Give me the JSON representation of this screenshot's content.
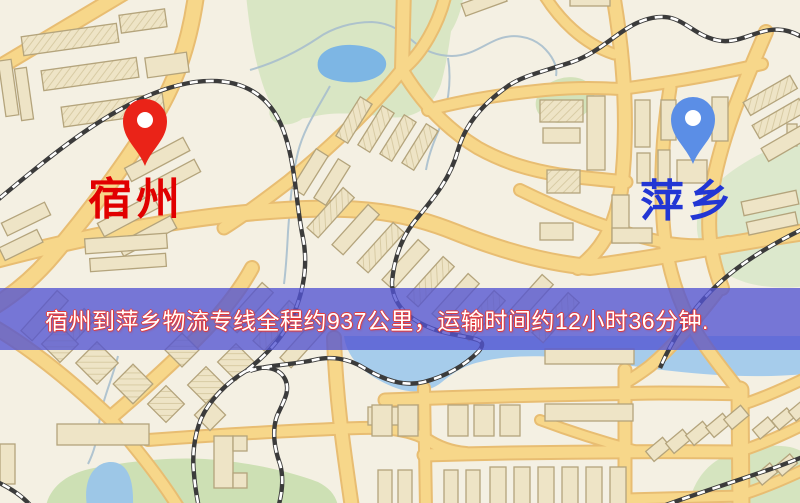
{
  "banner": {
    "text": "宿州到萍乡物流专线全程约937公里，运输时间约12小时36分钟.",
    "background_color": "#5253d2",
    "background_opacity": "0.78",
    "text_color": "#ffffff",
    "outline_color": "#e23b3b"
  },
  "markers": {
    "origin": {
      "label": "宿州",
      "label_color": "#e10000",
      "pin_color": "#ea2318"
    },
    "destination": {
      "label": "萍乡",
      "label_color": "#2236d4",
      "pin_color": "#5b8ee6"
    }
  },
  "map_palette": {
    "background": "#f4f0e3",
    "road_fill": "#f7d78a",
    "road_casing": "#e8bd72",
    "building": "#eee4c6",
    "green_area": "#d9e6c4",
    "water": "#a6cceb",
    "railway": "#3b3b3b"
  }
}
